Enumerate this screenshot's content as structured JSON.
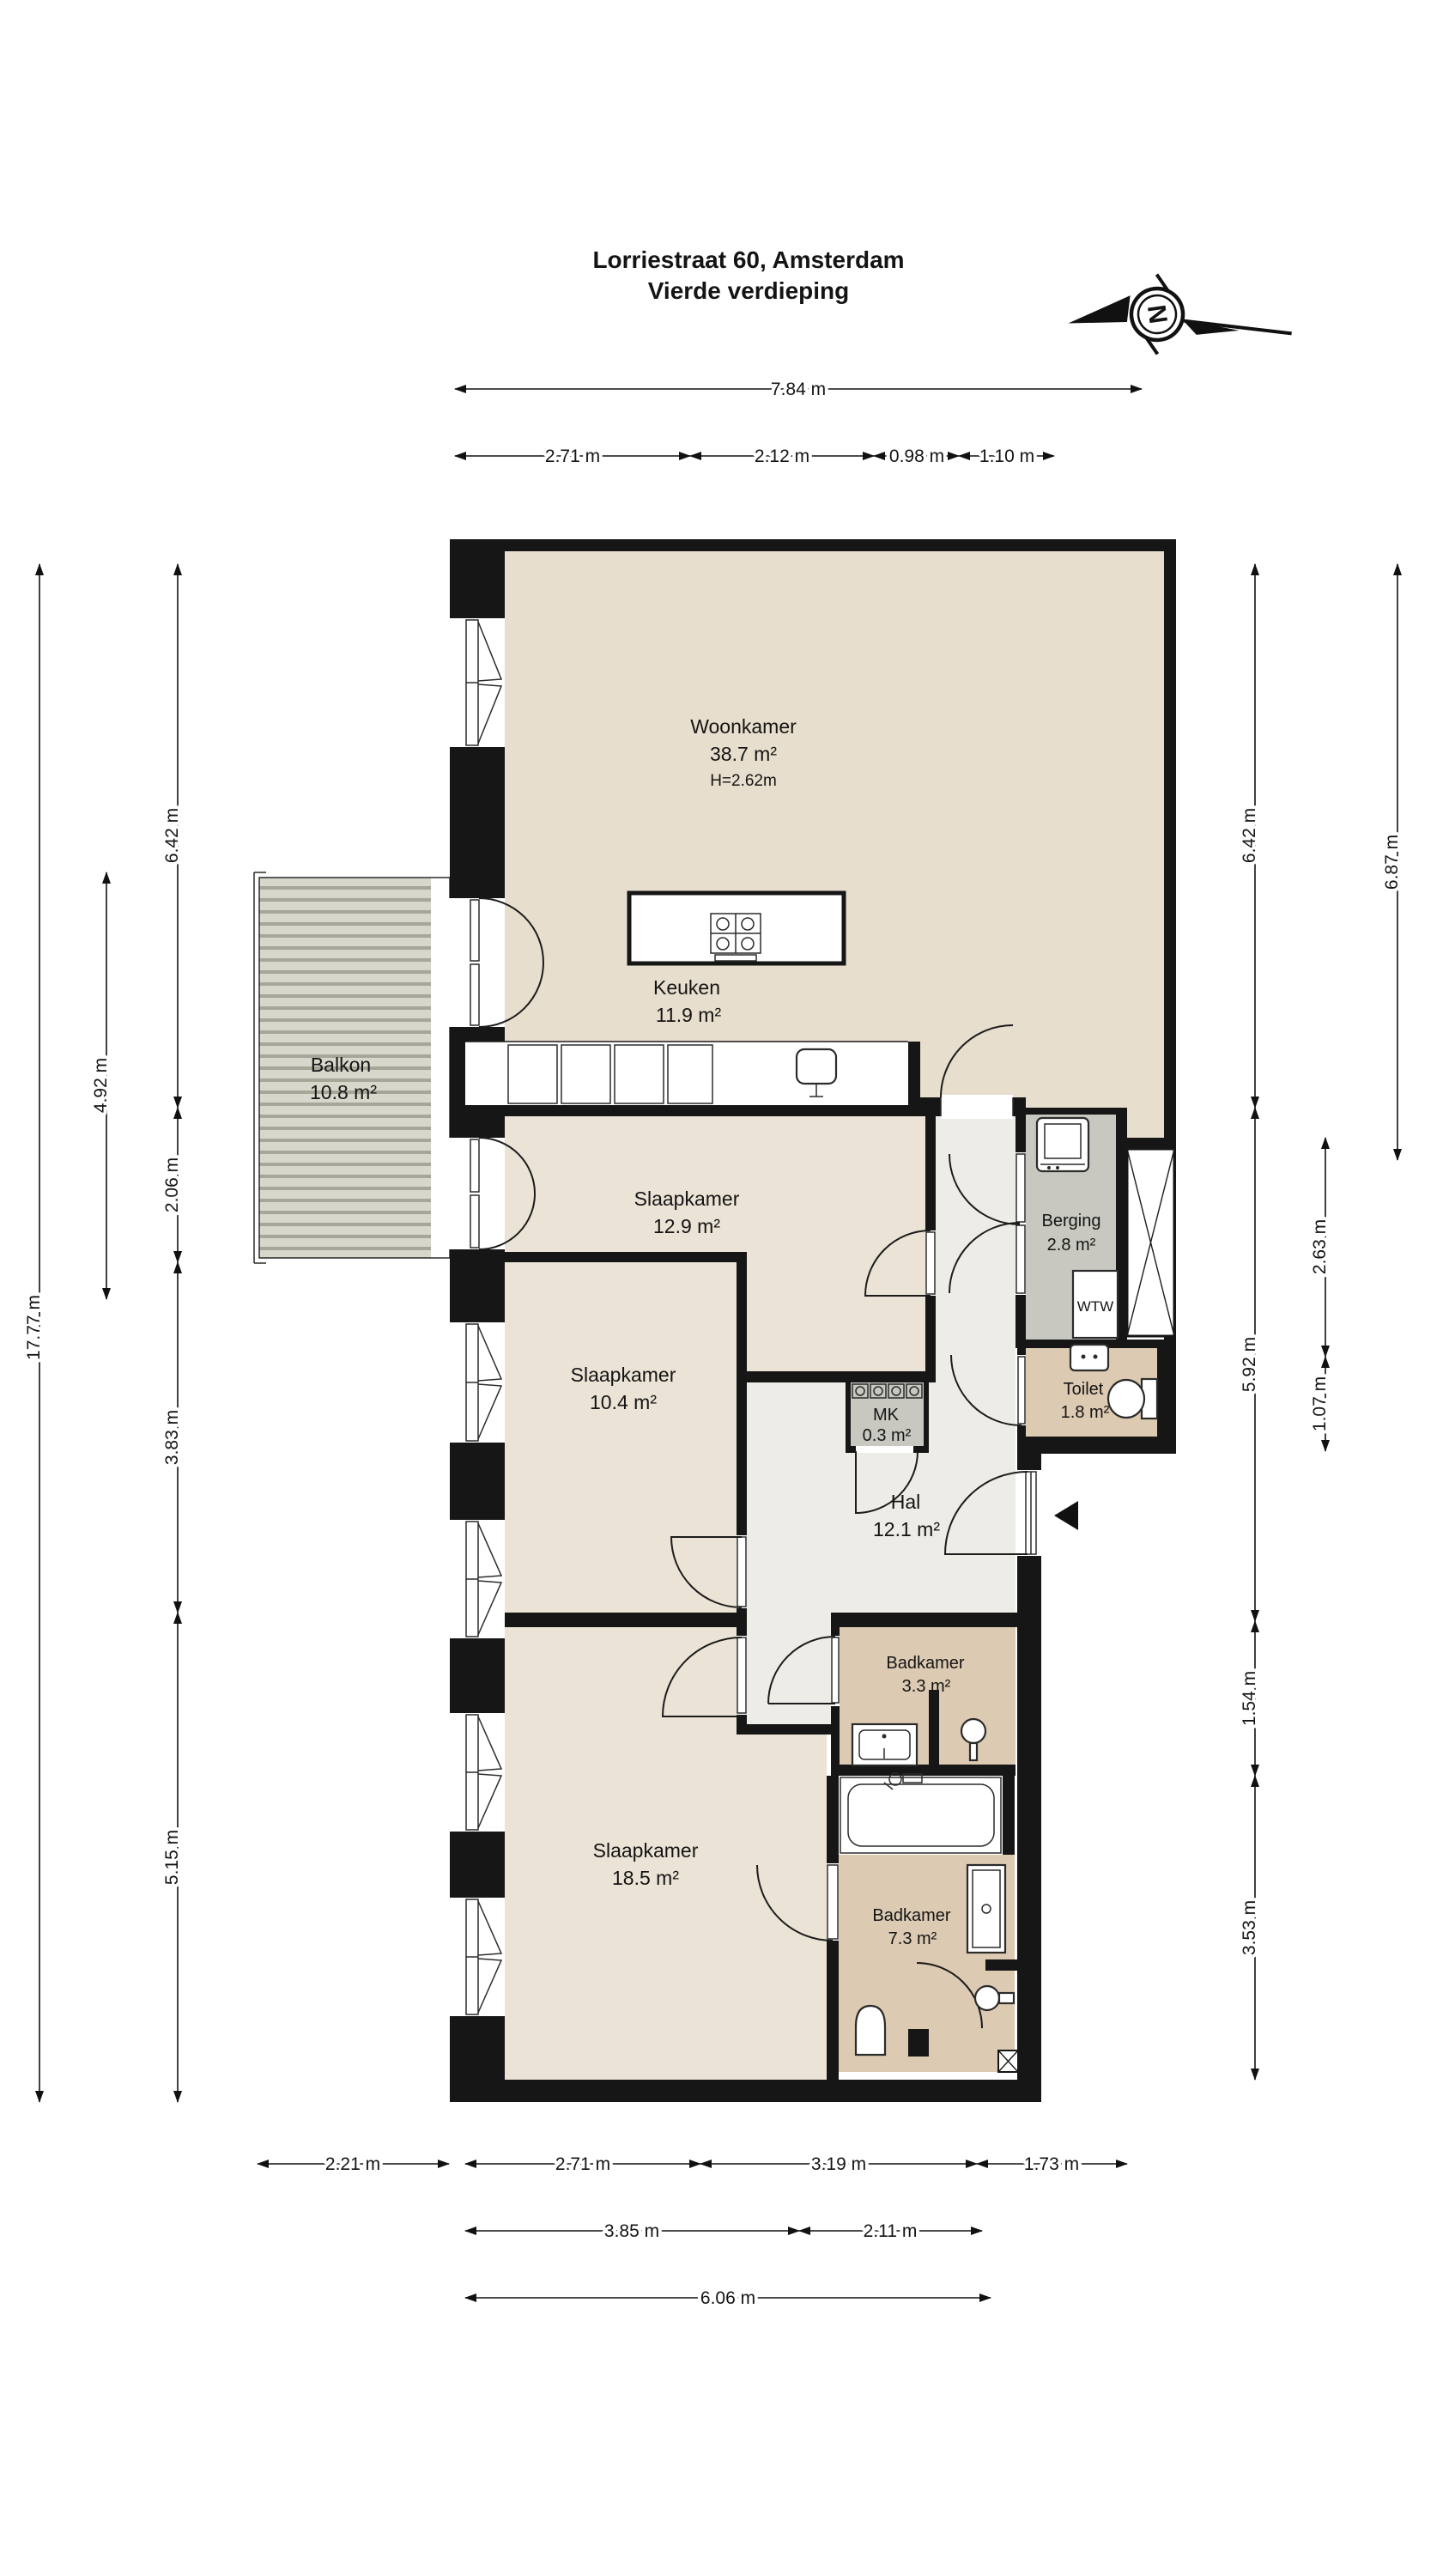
{
  "title": {
    "line1": "Lorriestraat 60, Amsterdam",
    "line2": "Vierde verdieping"
  },
  "compass": {
    "north_label": "N"
  },
  "rooms": {
    "woonkamer": {
      "name": "Woonkamer",
      "area": "38.7 m²",
      "ceiling": "H=2.62m"
    },
    "keuken": {
      "name": "Keuken",
      "area": "11.9 m²"
    },
    "balkon": {
      "name": "Balkon",
      "area": "10.8 m²"
    },
    "slaapkamer1": {
      "name": "Slaapkamer",
      "area": "12.9 m²"
    },
    "berging": {
      "name": "Berging",
      "area": "2.8 m²"
    },
    "wtw": {
      "label": "WTW"
    },
    "toilet": {
      "name": "Toilet",
      "area": "1.8 m²"
    },
    "mk": {
      "name": "MK",
      "area": "0.3 m²"
    },
    "hal": {
      "name": "Hal",
      "area": "12.1 m²"
    },
    "slaapkamer2": {
      "name": "Slaapkamer",
      "area": "10.4 m²"
    },
    "badkamer1": {
      "name": "Badkamer",
      "area": "3.3 m²"
    },
    "slaapkamer3": {
      "name": "Slaapkamer",
      "area": "18.5 m²"
    },
    "badkamer2": {
      "name": "Badkamer",
      "area": "7.3 m²"
    }
  },
  "dimensions": {
    "top_total": "7.84 m",
    "top_chain": {
      "a": "2.71 m",
      "b": "2.12 m",
      "c": "0.98 m",
      "d": "1.10 m"
    },
    "left_total": "17.77 m",
    "left_balkon": "4.92 m",
    "left_chain": {
      "a": "6.42 m",
      "b": "2.06 m",
      "c": "3.83 m",
      "d": "5.15 m"
    },
    "right_chain": {
      "a": "6.42 m",
      "b": "5.92 m",
      "c": "1.54 m",
      "d": "3.53 m"
    },
    "right_inner": {
      "a": "2.63 m",
      "b": "1.07 m"
    },
    "right_outer": "6.87 m",
    "bottom_row1": {
      "a": "2.21 m",
      "b": "2.71 m",
      "c": "3.19 m",
      "d": "1.73 m"
    },
    "bottom_row2": {
      "a": "3.85 m",
      "b": "2.11 m"
    },
    "bottom_row3": "6.06 m"
  },
  "colors": {
    "wall": "#161616",
    "floor_living": "#e7decd",
    "floor_bedroom": "#eae3d6",
    "floor_hall": "#edece6",
    "floor_bath": "#dccab2",
    "floor_storage": "#c8c8c1",
    "balcony_deck": "#d7d7cb"
  }
}
